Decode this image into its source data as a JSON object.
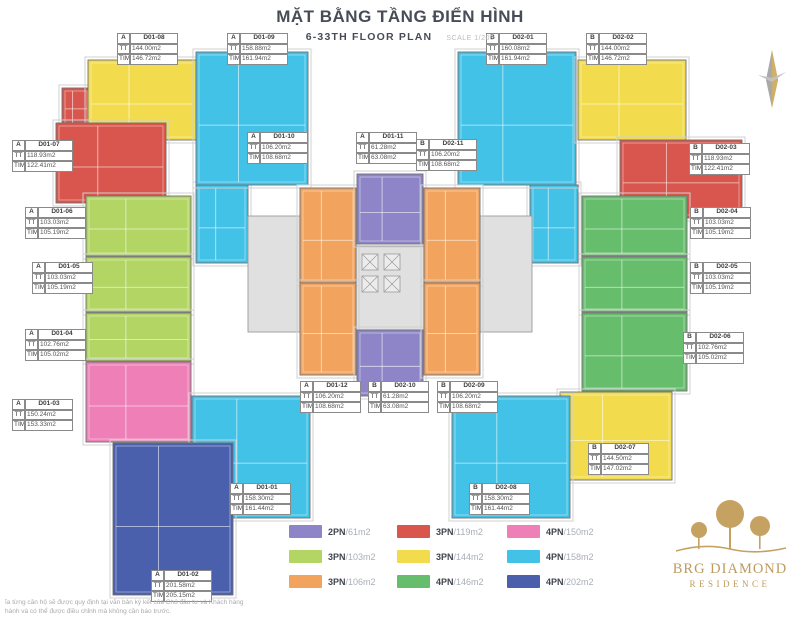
{
  "header": {
    "title": "MẶT BẰNG TẦNG ĐIỂN HÌNH",
    "subtitle": "6-33TH FLOOR PLAN",
    "scale": "SCALE 1/200"
  },
  "colors": {
    "purple": "#8d85c7",
    "red": "#d8564d",
    "pink": "#ee7fb7",
    "ltgreen": "#b2d564",
    "yellow": "#f2dc4d",
    "cyan": "#43c2e8",
    "orange": "#f2a35e",
    "green": "#66bd6c",
    "blue": "#4a60ad",
    "core": "#e0e0e0"
  },
  "label_keys": {
    "tt": "TT",
    "tim": "TIM"
  },
  "units": [
    {
      "block": "A",
      "code": "D01-08",
      "tt": "144.00m2",
      "tim": "146.72m2",
      "color": "yellow",
      "rect": [
        88,
        60,
        108,
        80
      ],
      "label": [
        117,
        33
      ]
    },
    {
      "block": "A",
      "code": "D01-09",
      "tt": "158.88m2",
      "tim": "161.94m2",
      "color": "cyan",
      "rect": [
        196,
        52,
        112,
        133
      ],
      "label": [
        227,
        33
      ]
    },
    {
      "block": "B",
      "code": "D02-01",
      "tt": "160.08m2",
      "tim": "161.94m2",
      "color": "cyan",
      "rect": [
        458,
        52,
        118,
        133
      ],
      "label": [
        486,
        33
      ]
    },
    {
      "block": "B",
      "code": "D02-02",
      "tt": "144.00m2",
      "tim": "146.72m2",
      "color": "yellow",
      "rect": [
        578,
        60,
        108,
        80
      ],
      "label": [
        586,
        33
      ]
    },
    {
      "block": "A",
      "code": "D01-07",
      "tt": "118.93m2",
      "tim": "122.41m2",
      "color": "red",
      "rect": [
        56,
        123,
        110,
        80
      ],
      "label": [
        12,
        140
      ]
    },
    {
      "block": "A",
      "code": "D01-10",
      "tt": "106.20m2",
      "tim": "108.68m2",
      "color": "orange",
      "rect": [
        300,
        188,
        56,
        95
      ],
      "label": [
        247,
        132
      ]
    },
    {
      "block": "A",
      "code": "D01-11",
      "tt": "61.28m2",
      "tim": "63.08m2",
      "color": "purple",
      "rect": [
        357,
        174,
        66,
        70
      ],
      "label": [
        356,
        132
      ]
    },
    {
      "block": "B",
      "code": "D02-11",
      "tt": "106.20m2",
      "tim": "108.68m2",
      "color": "orange",
      "rect": [
        424,
        188,
        56,
        95
      ],
      "label": [
        416,
        139
      ]
    },
    {
      "block": "B",
      "code": "D02-03",
      "tt": "118.93m2",
      "tim": "122.41m2",
      "color": "red",
      "rect": [
        620,
        140,
        122,
        78
      ],
      "label": [
        689,
        143
      ]
    },
    {
      "block": "A",
      "code": "D01-06",
      "tt": "103.03m2",
      "tim": "105.19m2",
      "color": "ltgreen",
      "rect": [
        86,
        196,
        105,
        60
      ],
      "label": [
        25,
        207
      ]
    },
    {
      "block": "B",
      "code": "D02-04",
      "tt": "103.03m2",
      "tim": "105.19m2",
      "color": "green",
      "rect": [
        582,
        196,
        105,
        60
      ],
      "label": [
        690,
        207
      ]
    },
    {
      "block": "A",
      "code": "D01-05",
      "tt": "103.03m2",
      "tim": "105.19m2",
      "color": "ltgreen",
      "rect": [
        86,
        257,
        105,
        55
      ],
      "label": [
        32,
        262
      ]
    },
    {
      "block": "B",
      "code": "D02-05",
      "tt": "103.03m2",
      "tim": "105.19m2",
      "color": "green",
      "rect": [
        582,
        257,
        105,
        55
      ],
      "label": [
        690,
        262
      ]
    },
    {
      "block": "A",
      "code": "D01-04",
      "tt": "102.76m2",
      "tim": "105.02m2",
      "color": "ltgreen",
      "rect": [
        86,
        313,
        105,
        48
      ],
      "label": [
        25,
        329
      ]
    },
    {
      "block": "B",
      "code": "D02-06",
      "tt": "102.76m2",
      "tim": "105.02m2",
      "color": "green",
      "rect": [
        582,
        313,
        105,
        78
      ],
      "label": [
        683,
        332
      ]
    },
    {
      "block": "A",
      "code": "D01-03",
      "tt": "150.24m2",
      "tim": "153.33m2",
      "color": "pink",
      "rect": [
        86,
        362,
        105,
        80
      ],
      "label": [
        12,
        399
      ]
    },
    {
      "block": "A",
      "code": "D01-12",
      "tt": "106.20m2",
      "tim": "108.68m2",
      "color": "orange",
      "rect": [
        300,
        283,
        56,
        92
      ],
      "label": [
        300,
        381
      ]
    },
    {
      "block": "B",
      "code": "D02-10",
      "tt": "61.28m2",
      "tim": "63.08m2",
      "color": "purple",
      "rect": [
        357,
        330,
        66,
        66
      ],
      "label": [
        368,
        381
      ]
    },
    {
      "block": "B",
      "code": "D02-09",
      "tt": "106.20m2",
      "tim": "108.68m2",
      "color": "orange",
      "rect": [
        424,
        283,
        56,
        92
      ],
      "label": [
        437,
        381
      ]
    },
    {
      "block": "B",
      "code": "D02-07",
      "tt": "144.50m2",
      "tim": "147.02m2",
      "color": "yellow",
      "rect": [
        560,
        392,
        112,
        88
      ],
      "label": [
        588,
        443
      ]
    },
    {
      "block": "A",
      "code": "D01-01",
      "tt": "158.30m2",
      "tim": "161.44m2",
      "color": "cyan",
      "rect": [
        192,
        396,
        118,
        122
      ],
      "label": [
        230,
        483
      ]
    },
    {
      "block": "B",
      "code": "D02-08",
      "tt": "158.30m2",
      "tim": "161.44m2",
      "color": "cyan",
      "rect": [
        452,
        396,
        118,
        122
      ],
      "label": [
        469,
        483
      ]
    },
    {
      "block": "A",
      "code": "D01-02",
      "tt": "201.58m2",
      "tim": "205.15m2",
      "color": "blue",
      "rect": [
        113,
        443,
        120,
        152
      ],
      "label": [
        151,
        570
      ]
    }
  ],
  "extras": [
    {
      "color": "cyan",
      "rect": [
        196,
        185,
        52,
        78
      ]
    },
    {
      "color": "cyan",
      "rect": [
        530,
        185,
        48,
        78
      ]
    },
    {
      "color": "red",
      "rect": [
        62,
        88,
        28,
        38
      ]
    }
  ],
  "cores": [
    {
      "rect": [
        248,
        216,
        52,
        116
      ]
    },
    {
      "rect": [
        480,
        216,
        52,
        116
      ]
    },
    {
      "rect": [
        356,
        246,
        68,
        84
      ]
    }
  ],
  "lifts": [
    [
      362,
      254,
      16
    ],
    [
      384,
      254,
      16
    ],
    [
      362,
      276,
      16
    ],
    [
      384,
      276,
      16
    ]
  ],
  "legend": [
    {
      "label": "2PN",
      "area": "/61m2",
      "color": "purple"
    },
    {
      "label": "3PN",
      "area": "/119m2",
      "color": "red"
    },
    {
      "label": "4PN",
      "area": "/150m2",
      "color": "pink"
    },
    {
      "label": "3PN",
      "area": "/103m2",
      "color": "ltgreen"
    },
    {
      "label": "3PN",
      "area": "/144m2",
      "color": "yellow"
    },
    {
      "label": "4PN",
      "area": "/158m2",
      "color": "cyan"
    },
    {
      "label": "3PN",
      "area": "/106m2",
      "color": "orange"
    },
    {
      "label": "4PN",
      "area": "/146m2",
      "color": "green"
    },
    {
      "label": "4PN",
      "area": "/202m2",
      "color": "blue"
    }
  ],
  "logo": {
    "line1": "BRG DIAMOND",
    "line2": "RESIDENCE",
    "color": "#bd9b5e"
  },
  "footer": {
    "line1": "ĩa từng căn hộ sẽ được quy định tại văn bản ký kết của Chủ đầu tư và Khách hàng",
    "line2": "hành và có thể được điều chỉnh mà không cần báo trước."
  }
}
